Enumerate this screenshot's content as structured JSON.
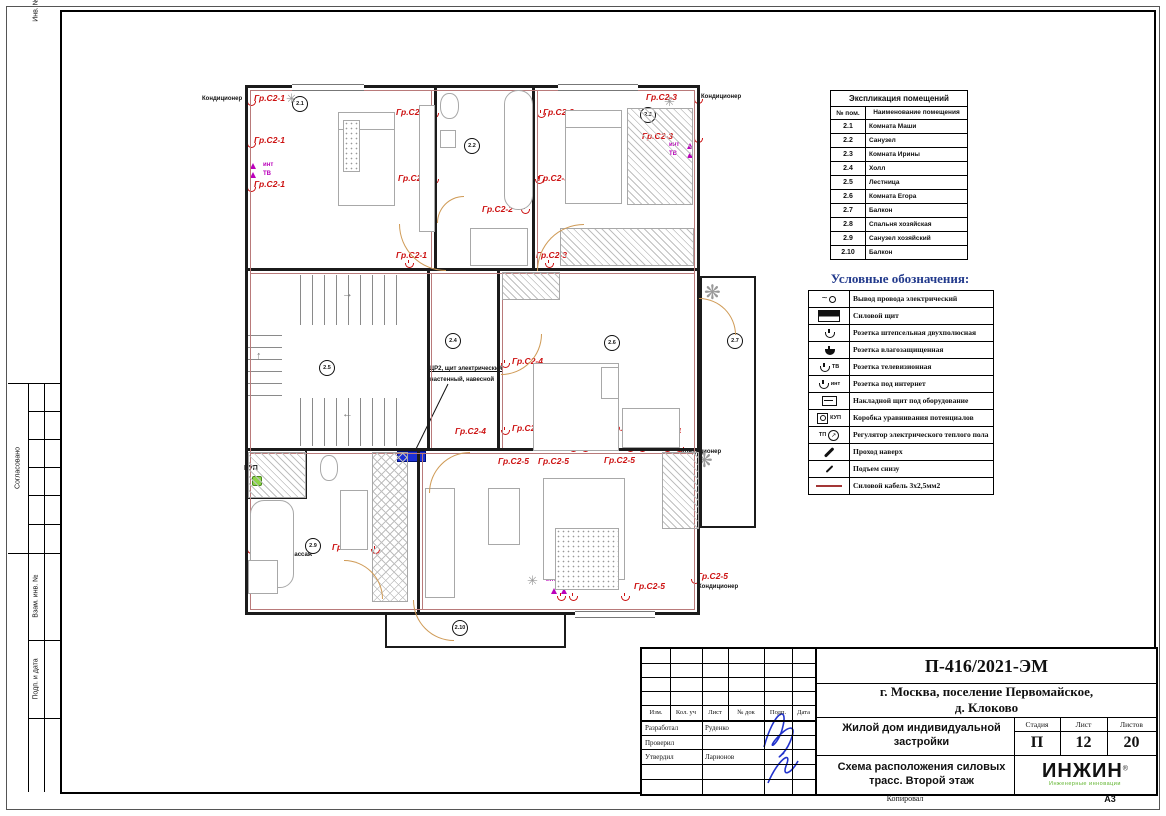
{
  "margin": {
    "approved": "Согласовано",
    "stamp1": "Взам. инв. №",
    "stamp2": "Подп. и дата",
    "stamp3": "Инв. № подл."
  },
  "explication": {
    "title": "Экспликация помещений",
    "col1": "№ пом.",
    "col2": "Наименование помещения",
    "rows": [
      [
        "2.1",
        "Комната Маши"
      ],
      [
        "2.2",
        "Санузел"
      ],
      [
        "2.3",
        "Комната Ирины"
      ],
      [
        "2.4",
        "Холл"
      ],
      [
        "2.5",
        "Лестница"
      ],
      [
        "2.6",
        "Комната Егора"
      ],
      [
        "2.7",
        "Балкон"
      ],
      [
        "2.8",
        "Спальня хозяйская"
      ],
      [
        "2.9",
        "Санузел хозяйский"
      ],
      [
        "2.10",
        "Балкон"
      ]
    ]
  },
  "legend": {
    "title": "Условные обозначения:",
    "items": [
      {
        "icon": "wire",
        "label": "Вывод провода электрический"
      },
      {
        "icon": "panel",
        "label": "Силовой щит"
      },
      {
        "icon": "socket",
        "label": "Розетка штепсельная двухполюсная"
      },
      {
        "icon": "socket-f",
        "label": "Розетка влагозащищенная"
      },
      {
        "icon": "socket-tv",
        "icon_text": "ТВ",
        "label": "Розетка телевизионная"
      },
      {
        "icon": "socket-int",
        "icon_text": "инт",
        "label": "Розетка под интернет"
      },
      {
        "icon": "box",
        "label": "Накладной щит под оборудование"
      },
      {
        "icon": "kup",
        "icon_text": "КУП",
        "label": "Коробка уравнивания потенциалов"
      },
      {
        "icon": "tp",
        "icon_text": "ТП",
        "label": "Регулятор электрического теплого пола"
      },
      {
        "icon": "up",
        "label": "Проход наверх"
      },
      {
        "icon": "rise",
        "label": "Подъем снизу"
      },
      {
        "icon": "cable",
        "label": "Силовой кабель 3х2,5мм2"
      }
    ]
  },
  "titleblock": {
    "doc_code": "П-416/2021-ЭМ",
    "location_line1": "г. Москва, поселение Первомайское,",
    "location_line2": "д. Клоково",
    "object": "Жилой дом индивидуальной застройки",
    "sheet_title": "Схема расположения силовых трасс. Второй этаж",
    "stage_label": "Стадия",
    "sheet_label": "Лист",
    "sheets_label": "Листов",
    "stage": "П",
    "sheet": "12",
    "sheets": "20",
    "header_cols": [
      "Изм.",
      "Кол. уч",
      "Лист",
      "№ док",
      "Подп.",
      "Дата"
    ],
    "roles": [
      {
        "role": "Разработал",
        "name": "Руденко"
      },
      {
        "role": "Проверил",
        "name": ""
      },
      {
        "role": "Утвердил",
        "name": "Ларионов"
      }
    ],
    "logo": {
      "name": "ИНЖИН",
      "reg": "®",
      "tagline": "Инженерные инновации"
    },
    "copied": "Копировал",
    "format": "А3"
  },
  "plan": {
    "shield_note_line1": "ЩР2, щит электрический",
    "shield_note_line2": "настенный, навесной",
    "room_circles": [
      {
        "n": "2.1",
        "x": 300,
        "y": 104
      },
      {
        "n": "2.2",
        "x": 472,
        "y": 146
      },
      {
        "n": "2.3",
        "x": 648,
        "y": 115
      },
      {
        "n": "2.4",
        "x": 453,
        "y": 341
      },
      {
        "n": "2.5",
        "x": 327,
        "y": 368
      },
      {
        "n": "2.6",
        "x": 612,
        "y": 343
      },
      {
        "n": "2.7",
        "x": 735,
        "y": 341
      },
      {
        "n": "2.8",
        "x": 436,
        "y": 552
      },
      {
        "n": "2.9",
        "x": 313,
        "y": 546
      },
      {
        "n": "2.10",
        "x": 460,
        "y": 628
      }
    ],
    "circuit_labels": [
      {
        "t": "Гр.С2-1",
        "x": 254,
        "y": 93
      },
      {
        "t": "Гр.С2-1",
        "x": 254,
        "y": 135
      },
      {
        "t": "Гр.С2-1",
        "x": 254,
        "y": 179
      },
      {
        "t": "Гр.С2-1",
        "x": 396,
        "y": 107
      },
      {
        "t": "Гр.С2-1",
        "x": 398,
        "y": 173
      },
      {
        "t": "Гр.С2-1",
        "x": 396,
        "y": 250
      },
      {
        "t": "Гр.С2-2",
        "x": 482,
        "y": 204
      },
      {
        "t": "Гр.С2-3",
        "x": 543,
        "y": 107
      },
      {
        "t": "Гр.С2-3",
        "x": 538,
        "y": 173
      },
      {
        "t": "Гр.С2-3",
        "x": 536,
        "y": 250
      },
      {
        "t": "Гр.С2-3",
        "x": 646,
        "y": 92
      },
      {
        "t": "Гр.С2-3",
        "x": 642,
        "y": 131
      },
      {
        "t": "Гр.С2-4",
        "x": 512,
        "y": 356
      },
      {
        "t": "Гр.С2-4",
        "x": 512,
        "y": 423
      },
      {
        "t": "Гр.С2-4",
        "x": 455,
        "y": 426
      },
      {
        "t": "Гр.С2-4",
        "x": 610,
        "y": 423
      },
      {
        "t": "Гр.С2-4",
        "x": 650,
        "y": 426
      },
      {
        "t": "Гр.С2-5",
        "x": 604,
        "y": 455
      },
      {
        "t": "Гр.С2-5",
        "x": 498,
        "y": 456
      },
      {
        "t": "Гр.С2-5",
        "x": 538,
        "y": 456
      },
      {
        "t": "Гр.С2-6",
        "x": 258,
        "y": 540
      },
      {
        "t": "Гр.С2-2",
        "x": 332,
        "y": 542
      },
      {
        "t": "Гр.С2-5",
        "x": 557,
        "y": 576
      },
      {
        "t": "Гр.С2-5",
        "x": 634,
        "y": 581
      },
      {
        "t": "Гр.С2-5",
        "x": 697,
        "y": 571
      }
    ],
    "black_labels": [
      {
        "t": "Кондиционер",
        "x": 202,
        "y": 96
      },
      {
        "t": "Кондиционер",
        "x": 701,
        "y": 94
      },
      {
        "t": "Кондиционер",
        "x": 681,
        "y": 449
      },
      {
        "t": "Кондиционер",
        "x": 698,
        "y": 584
      },
      {
        "t": "Гидромассаж",
        "x": 272,
        "y": 552
      },
      {
        "t": "ЩР2, щит электрический",
        "x": 428,
        "y": 366,
        "u": true
      },
      {
        "t": "настенный, навесной",
        "x": 430,
        "y": 377
      },
      {
        "t": "КУП",
        "x": 506,
        "y": 136,
        "b": true
      },
      {
        "t": "КУП",
        "x": 244,
        "y": 465,
        "b": true
      }
    ],
    "magenta_labels": [
      {
        "t": "инт",
        "x": 263,
        "y": 162
      },
      {
        "t": "ТВ",
        "x": 263,
        "y": 171
      },
      {
        "t": "инт",
        "x": 669,
        "y": 142
      },
      {
        "t": "ТВ",
        "x": 669,
        "y": 151
      },
      {
        "t": "ТВ",
        "x": 590,
        "y": 417
      },
      {
        "t": "инт",
        "x": 590,
        "y": 425
      },
      {
        "t": "ТВ",
        "x": 546,
        "y": 569
      },
      {
        "t": "инт",
        "x": 546,
        "y": 577
      }
    ],
    "sockets": [
      {
        "x": 246,
        "y": 98
      },
      {
        "x": 246,
        "y": 140
      },
      {
        "x": 246,
        "y": 184
      },
      {
        "x": 429,
        "y": 110
      },
      {
        "x": 429,
        "y": 176
      },
      {
        "x": 404,
        "y": 260
      },
      {
        "x": 536,
        "y": 110
      },
      {
        "x": 534,
        "y": 176
      },
      {
        "x": 544,
        "y": 260
      },
      {
        "x": 693,
        "y": 96
      },
      {
        "x": 693,
        "y": 135
      },
      {
        "x": 520,
        "y": 206
      },
      {
        "x": 500,
        "y": 360
      },
      {
        "x": 500,
        "y": 427
      },
      {
        "x": 568,
        "y": 444
      },
      {
        "x": 580,
        "y": 444
      },
      {
        "x": 625,
        "y": 444
      },
      {
        "x": 637,
        "y": 444
      },
      {
        "x": 662,
        "y": 444
      },
      {
        "x": 674,
        "y": 444
      },
      {
        "x": 246,
        "y": 546
      },
      {
        "x": 370,
        "y": 546
      },
      {
        "x": 556,
        "y": 593
      },
      {
        "x": 568,
        "y": 593
      },
      {
        "x": 620,
        "y": 593
      },
      {
        "x": 690,
        "y": 576
      }
    ],
    "magenta_sockets": [
      {
        "x": 250,
        "y": 163
      },
      {
        "x": 250,
        "y": 172
      },
      {
        "x": 687,
        "y": 143
      },
      {
        "x": 687,
        "y": 152
      },
      {
        "x": 598,
        "y": 438
      },
      {
        "x": 608,
        "y": 438
      },
      {
        "x": 551,
        "y": 588
      },
      {
        "x": 561,
        "y": 588
      }
    ],
    "snowflakes": [
      {
        "x": 286,
        "y": 91
      },
      {
        "x": 664,
        "y": 94
      },
      {
        "x": 634,
        "y": 416
      },
      {
        "x": 527,
        "y": 573
      }
    ],
    "plants": [
      {
        "x": 704,
        "y": 280
      },
      {
        "x": 696,
        "y": 448
      }
    ]
  }
}
